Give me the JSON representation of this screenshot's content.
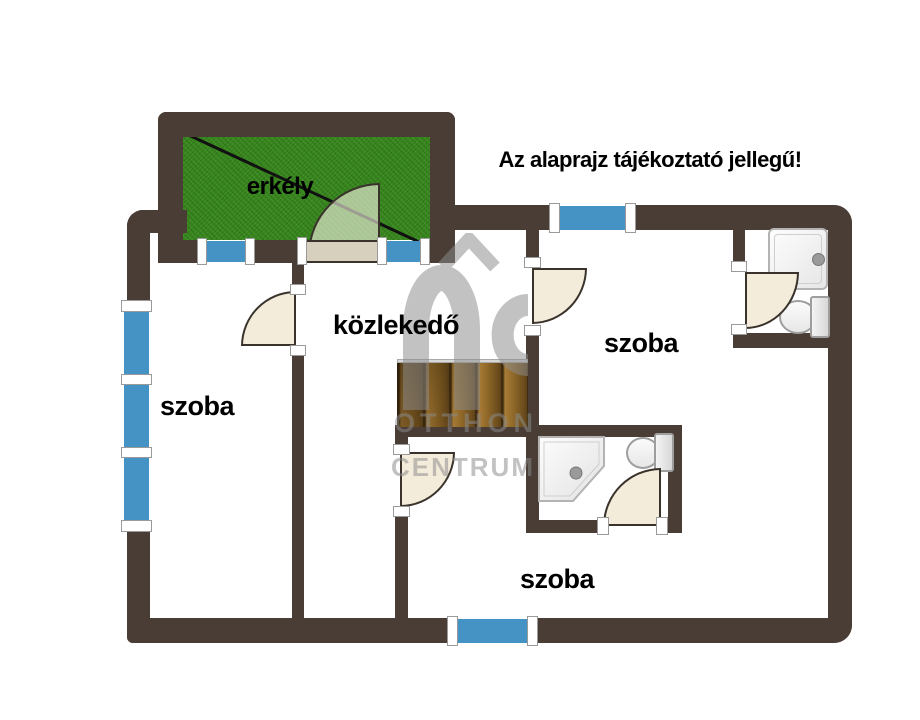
{
  "title": "Az alaprajz tájékoztató jellegű!",
  "rooms": {
    "balcony": "erkély",
    "hallway": "közlekedő",
    "room_left": "szoba",
    "room_top_right": "szoba",
    "room_bottom": "szoba"
  },
  "watermark": {
    "logo": "OC",
    "line1": "OTTHON",
    "line2": "CENTRUM"
  },
  "icons": {
    "stairs": "stairs",
    "shower_square": "shower-tray",
    "shower_corner": "corner-shower-tray",
    "toilet": "toilet",
    "door_swing": "door-swing",
    "window": "window",
    "roof_logo": "house-roof"
  },
  "colors": {
    "wall": "#4a3d35",
    "window": "#4493c4",
    "grass": "#37881c",
    "door": "#f4ecdb",
    "door_line": "#3a332c",
    "leaf": "#d8d0bf",
    "watermark": "#8c8c8c"
  }
}
